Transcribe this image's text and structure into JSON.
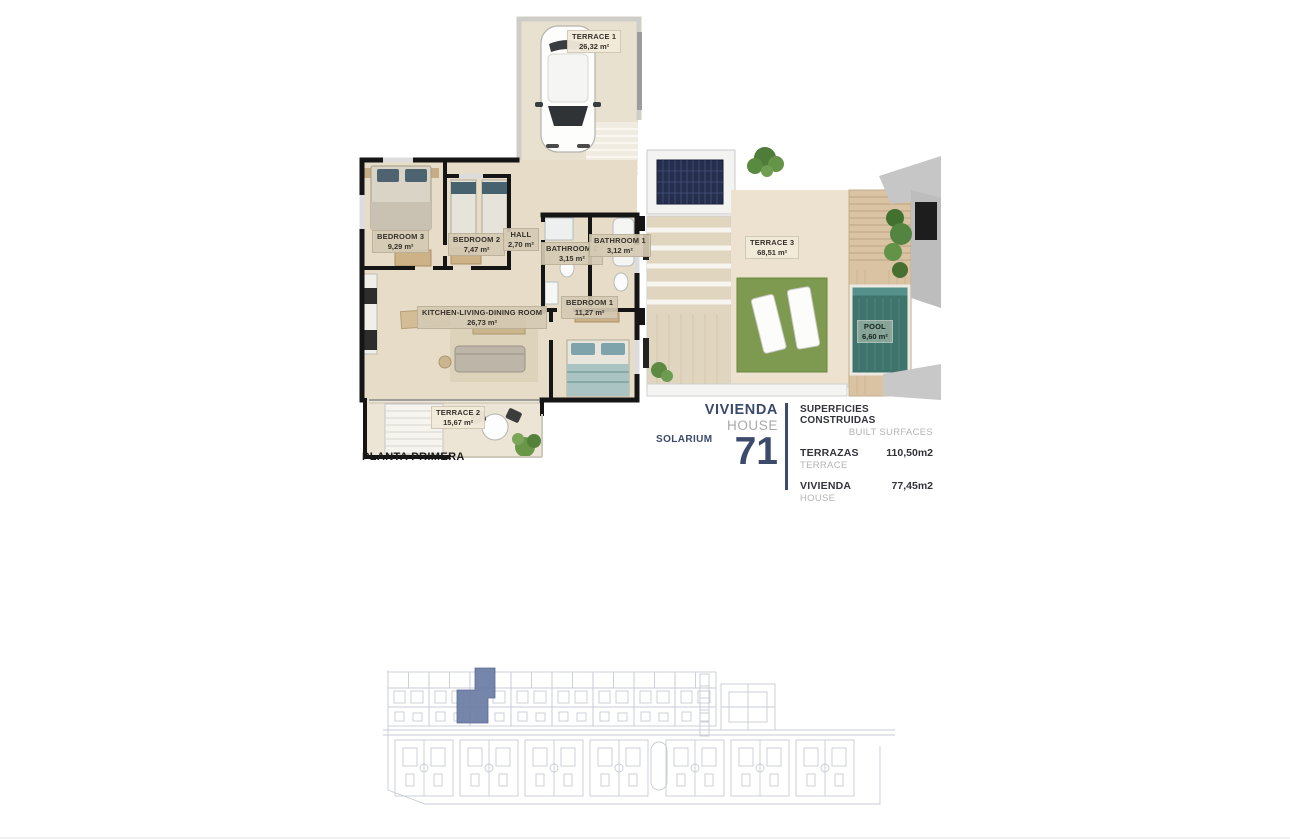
{
  "plan": {
    "floor_label": "PLANTA PRIMERA",
    "rooms": {
      "terrace1": {
        "name": "TERRACE 1",
        "area": "26,32 m²"
      },
      "bedroom3": {
        "name": "BEDROOM 3",
        "area": "9,29 m²"
      },
      "bedroom2": {
        "name": "BEDROOM 2",
        "area": "7,47 m²"
      },
      "hall": {
        "name": "HALL",
        "area": "2,70 m²"
      },
      "bathroom2": {
        "name": "BATHROOM 2",
        "area": "3,15 m²"
      },
      "bathroom1": {
        "name": "BATHROOM 1",
        "area": "3,12 m²"
      },
      "bedroom1": {
        "name": "BEDROOM 1",
        "area": "11,27 m²"
      },
      "kitchen": {
        "name": "KITCHEN-LIVING-DINING ROOM",
        "area": "26,73 m²"
      },
      "terrace2": {
        "name": "TERRACE 2",
        "area": "15,67 m²"
      }
    }
  },
  "solarium": {
    "label": "SOLARIUM",
    "rooms": {
      "terrace3": {
        "name": "TERRACE 3",
        "area": "68,51 m²"
      },
      "pool": {
        "name": "POOL",
        "area": "6,60 m²"
      }
    }
  },
  "unit": {
    "type_es": "VIVIENDA",
    "type_en": "HOUSE",
    "number": "71"
  },
  "surfaces": {
    "title_es": "SUPERFICIES CONSTRUIDAS",
    "title_en": "BUILT SURFACES",
    "rows": [
      {
        "label_es": "TERRAZAS",
        "label_en": "TERRACE",
        "value": "110,50m2"
      },
      {
        "label_es": "VIVIENDA",
        "label_en": "HOUSE",
        "value": "77,45m2"
      }
    ]
  },
  "colors": {
    "accent_navy": "#3c4a6b",
    "highlight_unit_blue": "#6f7ea5",
    "pool_teal": "#3f746d",
    "grass_green": "#7e9a50",
    "wall_black": "#151515",
    "floor_beige": "#e7dcc7",
    "siteplan_line": "#c7cbd5"
  }
}
